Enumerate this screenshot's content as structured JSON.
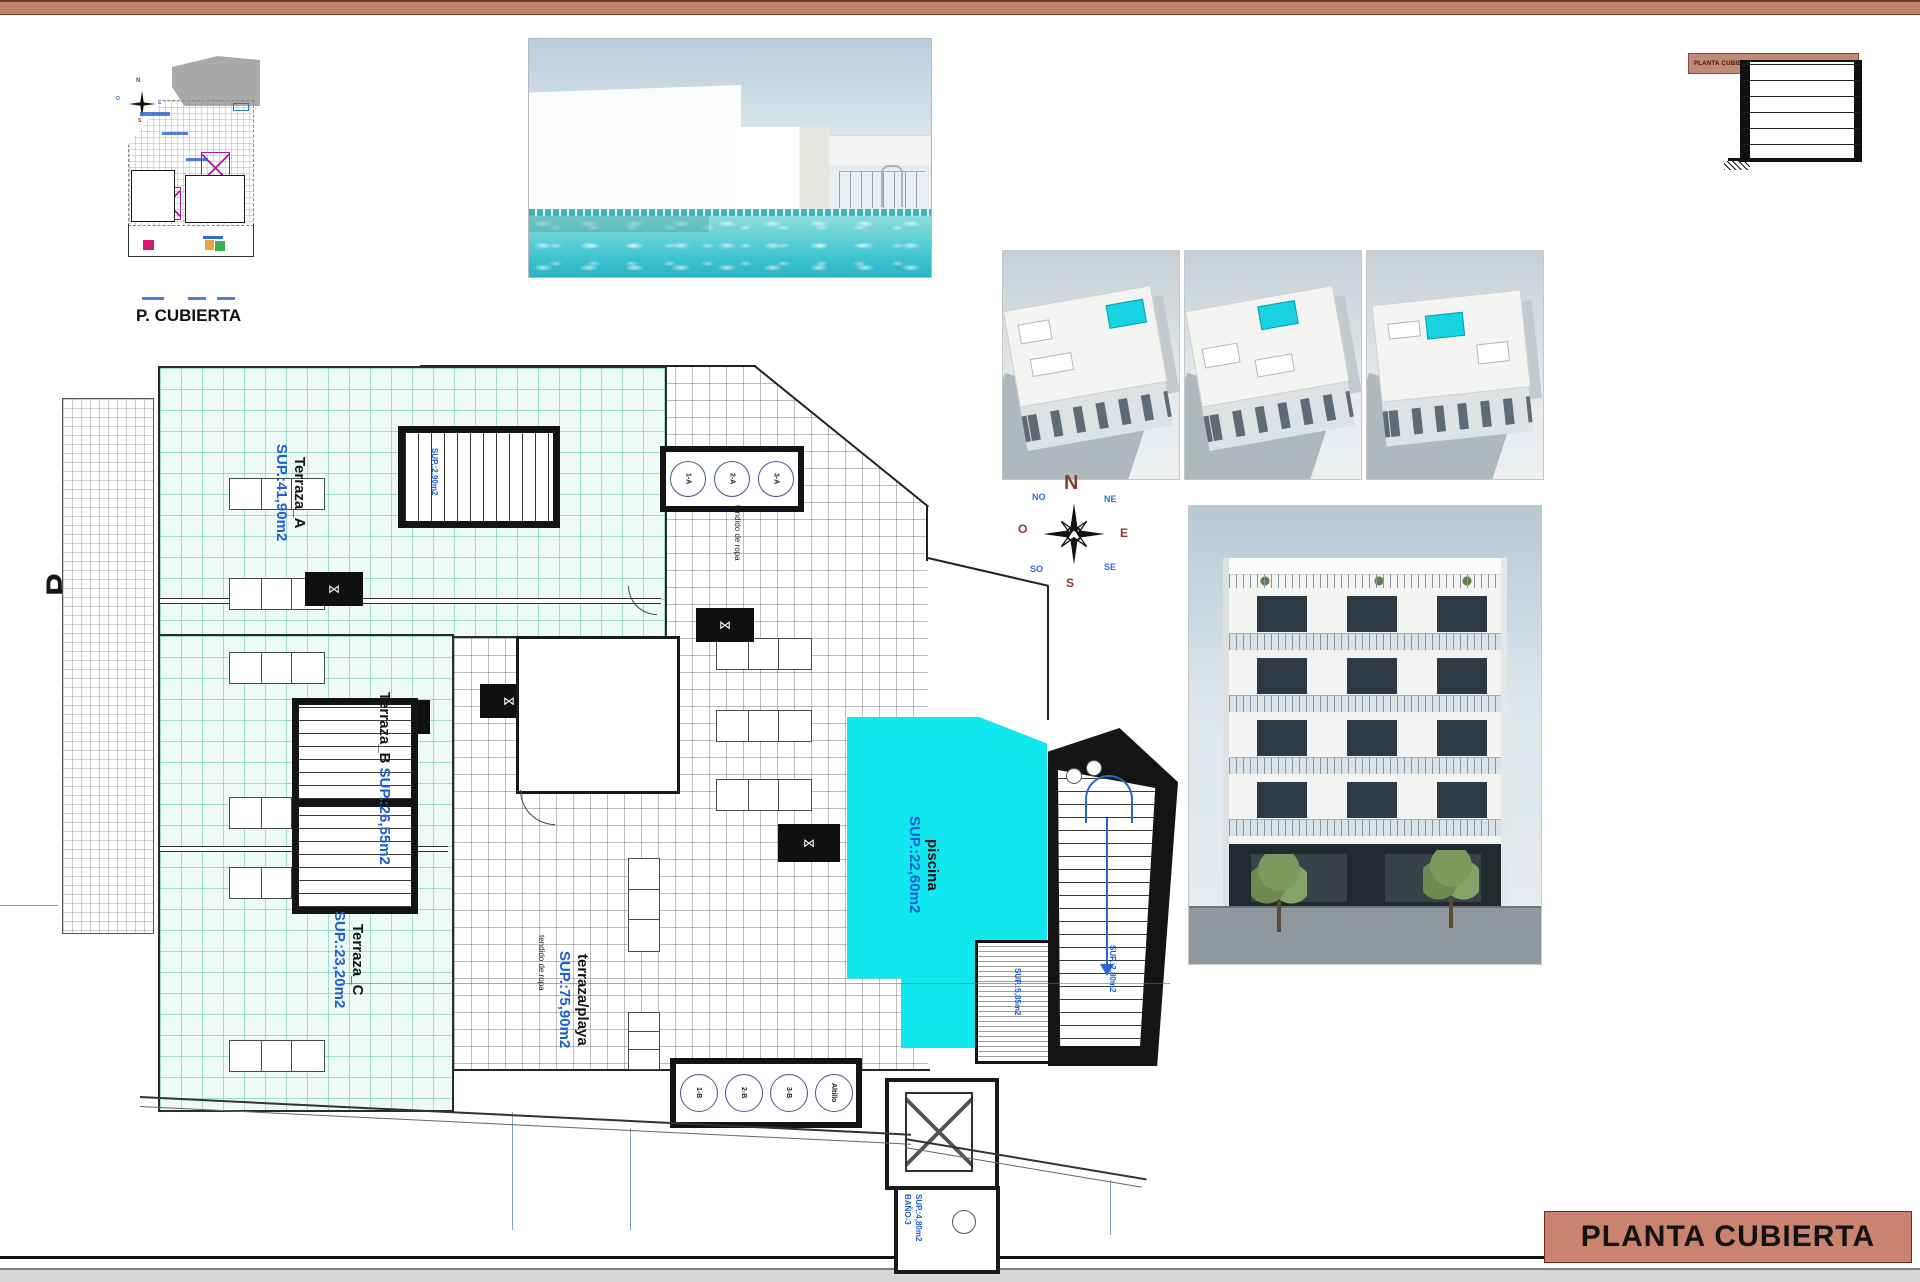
{
  "sheet": {
    "side_label": "P. CUBIERTA",
    "title_block": "PLANTA CUBIERTA",
    "mini_section_label": "PLANTA CUBIERTA",
    "site_plan_caption": "P. CUBIERTA"
  },
  "compass": {
    "n": "N",
    "e": "E",
    "s": "S",
    "w": "O",
    "ne": "NE",
    "nw": "NO",
    "se": "SE",
    "sw": "SO"
  },
  "plan": {
    "terrace_a": {
      "name": "Terraza_A",
      "area": "SUP.:41,90m2"
    },
    "terrace_b": {
      "name": "Terraza_B",
      "area": "SUP.:26,55m2"
    },
    "terrace_c": {
      "name": "Terraza_C",
      "area": "SUP.:23,20m2"
    },
    "deck": {
      "name": "terraza/playa",
      "area": "SUP.:75,90m2"
    },
    "pool": {
      "name": "piscina",
      "area": "SUP.:22,60m2"
    },
    "stair_a_label": "SUP.:2,90m2",
    "stair_right_label": "SUP.:2,80m2",
    "solarium_label": "SUP.:5,85m2",
    "bath": {
      "name": "BAÑO-3",
      "area": "SUP.:4,80m2"
    },
    "drying_label": "tendido de ropa",
    "top_units": [
      "1-A",
      "2-A",
      "3-A"
    ],
    "bottom_units": [
      "1-B",
      "2-B",
      "3-B",
      "Altillo"
    ]
  }
}
